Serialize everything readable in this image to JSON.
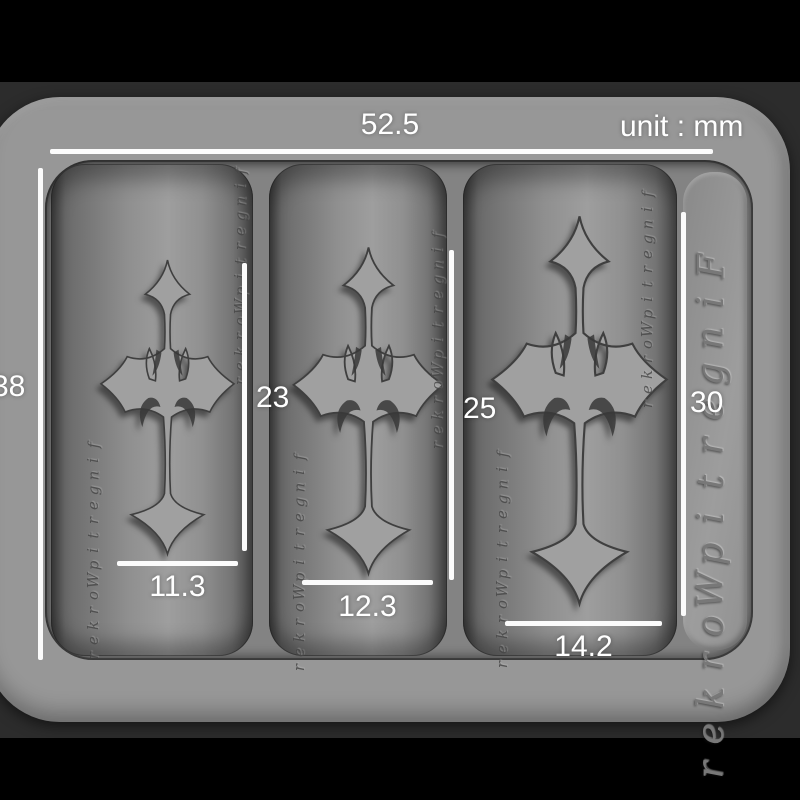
{
  "unit_label": "unit : mm",
  "brand": {
    "logo_text": "FingertipWorker",
    "watermark_text": "fingertipWorker"
  },
  "dimensions": {
    "overall_width_mm": "52.5",
    "overall_height_mm": "38",
    "cavity_1": {
      "height_mm": "23",
      "width_mm": "11.3"
    },
    "cavity_2": {
      "height_mm": "25",
      "width_mm": "12.3"
    },
    "cavity_3": {
      "height_mm": "30",
      "width_mm": "14.2"
    }
  },
  "colors": {
    "background": "#000000",
    "backdrop": "#2c2c2c",
    "mold_body": "#979797",
    "recess": "#838383",
    "dimension_markings": "#ffffff"
  }
}
